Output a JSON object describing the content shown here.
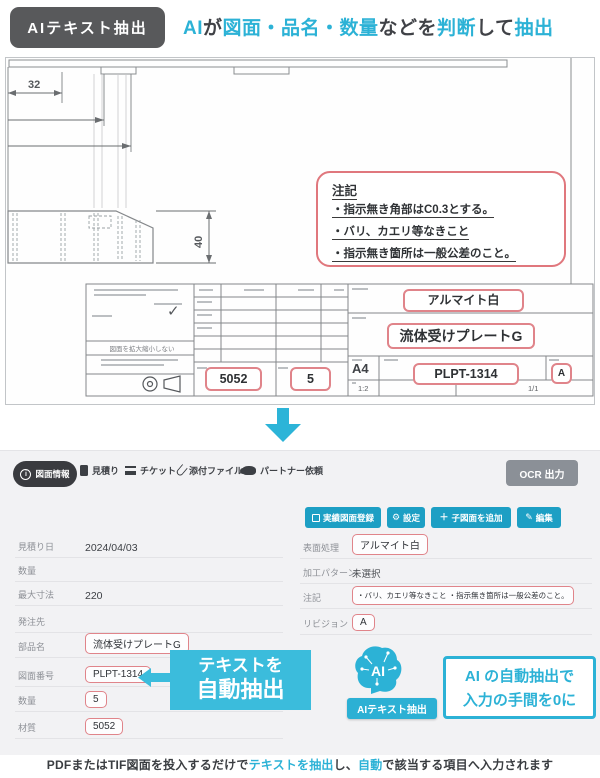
{
  "header": {
    "badge": "AIテキスト抽出"
  },
  "headline": {
    "parts": [
      {
        "text": "AI",
        "accent": true
      },
      {
        "text": "が",
        "accent": false
      },
      {
        "text": "図面・品名・数量",
        "accent": true
      },
      {
        "text": "などを",
        "accent": false
      },
      {
        "text": "判断",
        "accent": true
      },
      {
        "text": "して",
        "accent": false
      },
      {
        "text": "抽出",
        "accent": true
      }
    ]
  },
  "drawing": {
    "dim_width": "32",
    "dim_height": "40",
    "note": {
      "title": "注記",
      "line1": "・指示無き角部はC0.3とする。",
      "line2": "・バリ、カエリ等なきこと",
      "line3": "・指示無き箇所は一般公差のこと。"
    },
    "title_block": {
      "surface": "アルマイト白",
      "part_name": "流体受けプレートG",
      "paper_size": "A4",
      "drawing_number": "PLPT-1314",
      "revision": "A",
      "material": "5052",
      "quantity": "5",
      "scale": "1:2",
      "sheet": "1/1",
      "no_scale_note": "図面を拡大縮小しない",
      "check_mark": "✓"
    }
  },
  "form": {
    "tabs": [
      {
        "label": "図面情報"
      },
      {
        "label": "見積り"
      },
      {
        "label": "チケット"
      },
      {
        "label": "添付ファイル"
      },
      {
        "label": "パートナー依頼"
      }
    ],
    "ocr_button": "OCR 出力",
    "toolbar": {
      "register": "実績図面登録",
      "settings": "設定",
      "add_child": "子図面を追加",
      "edit": "編集",
      "settings_icon": "⚙",
      "add_icon": "＋",
      "edit_icon": "✎"
    },
    "fields_left": [
      {
        "label": "見積り日",
        "value": "2024/04/03"
      },
      {
        "label": "数量",
        "value": ""
      },
      {
        "label": "最大寸法",
        "value": "220"
      },
      {
        "label": "発注先",
        "value": ""
      },
      {
        "label": "部品名",
        "value": "流体受けプレートG"
      },
      {
        "label": "図面番号",
        "value": "PLPT-1314"
      },
      {
        "label": "数量",
        "value": "5"
      },
      {
        "label": "材質",
        "value": "5052"
      }
    ],
    "fields_right": [
      {
        "label": "表面処理",
        "value": "アルマイト白"
      },
      {
        "label": "加工パターン",
        "value": "未選択"
      },
      {
        "label": "注記",
        "value": "・バリ、カエリ等なきこと ・指示無き箇所は一般公差のこと。"
      },
      {
        "label": "リビジョン",
        "value": "A"
      }
    ],
    "callout_extract": {
      "line1": "テキストを",
      "line2": "自動抽出"
    },
    "ai": {
      "brain_label": "AI",
      "badge": "AIテキスト抽出"
    },
    "callout_zero": {
      "line1": "AI の自動抽出で",
      "line2": "入力の手間を0に"
    }
  },
  "footer": {
    "parts": [
      {
        "text": "PDFまたはTIF図面を投入するだけで",
        "accent": false
      },
      {
        "text": "テキストを抽出",
        "accent": true
      },
      {
        "text": "し、",
        "accent": false
      },
      {
        "text": "自動",
        "accent": true
      },
      {
        "text": "で該当する項目へ入力されます",
        "accent": false
      }
    ]
  },
  "colors": {
    "accent": "#2cb2d6",
    "button_blue": "#1d9fc4",
    "highlight_border": "#e0848a",
    "badge_bg": "#58595b"
  }
}
